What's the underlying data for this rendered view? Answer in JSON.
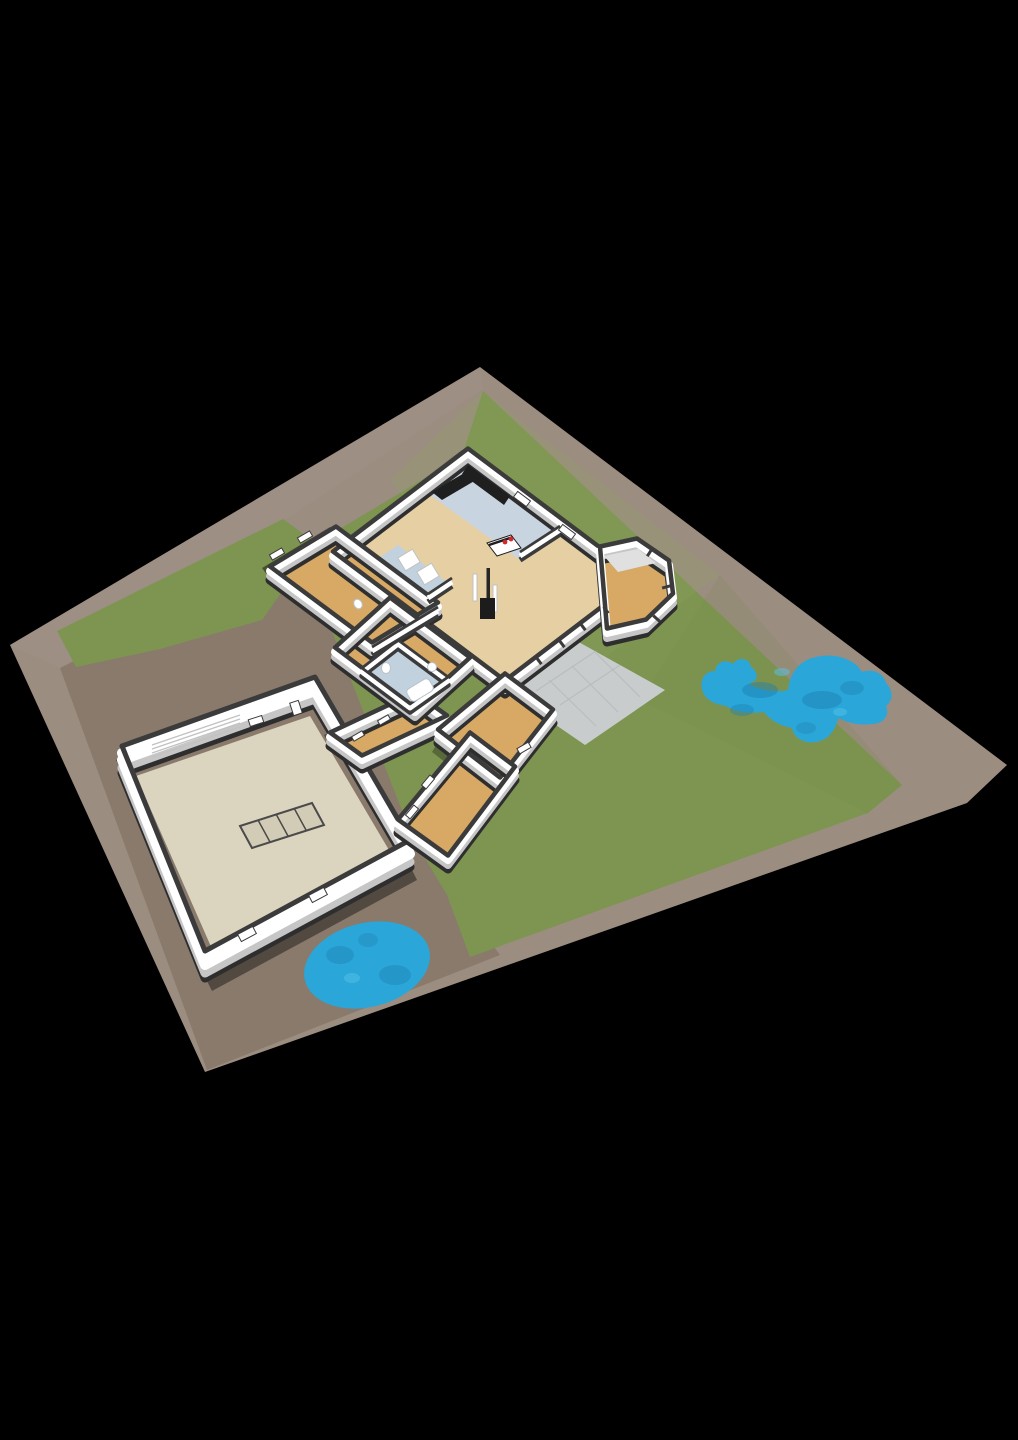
{
  "scene": {
    "type": "3d-floor-plan-site-render",
    "background": "#000000",
    "buildings": [
      "main-house",
      "garage",
      "connecting-corridor"
    ],
    "water_features": [
      "garden-pond",
      "oval-pool"
    ],
    "ground_areas": [
      "dirt-lot",
      "main-lawn",
      "west-lawn-strip",
      "terrace"
    ]
  },
  "features": {
    "skylight_panes": 4,
    "hob_burners": 2,
    "ponds": 2,
    "buildings": 2
  },
  "colors": {
    "bg": "#000000",
    "dirt": "#9c8d81",
    "dirt_yard": "#877869",
    "dirt_light": "#a3948a",
    "grass": "#7e9552",
    "grass_light": "#8aa25d",
    "grass_dark": "#738d48",
    "water": "#2ba6d8",
    "water_dark": "#1d7fb2",
    "water_light": "#55c2e8",
    "terrace": "#c9cccd",
    "terrace_line": "#b4b8b9",
    "floor_wood": "#d7a964",
    "floor_living": "#e6cfa3",
    "floor_kitchen": "#c9d4e1",
    "floor_bath": "#c2d1de",
    "floor_garage": "#dbd4bf",
    "skylight": "#d2cbb6",
    "skylight_line": "#4a4a4a",
    "wall_white": "#ffffff",
    "wall_gray": "#c6c6c6",
    "wall_cut": "#3b3b3b",
    "wall_base": "#2e2e2e",
    "roof_light": "#e0e0e0",
    "counter": "#1f1f1f",
    "stove": "#1c1c1c",
    "chimney": "#262626",
    "hob": "#cf2b2b",
    "fixture_stroke": "#b9c4cc",
    "appliance_stroke": "#c2c2c2",
    "shadow": "#000000"
  }
}
